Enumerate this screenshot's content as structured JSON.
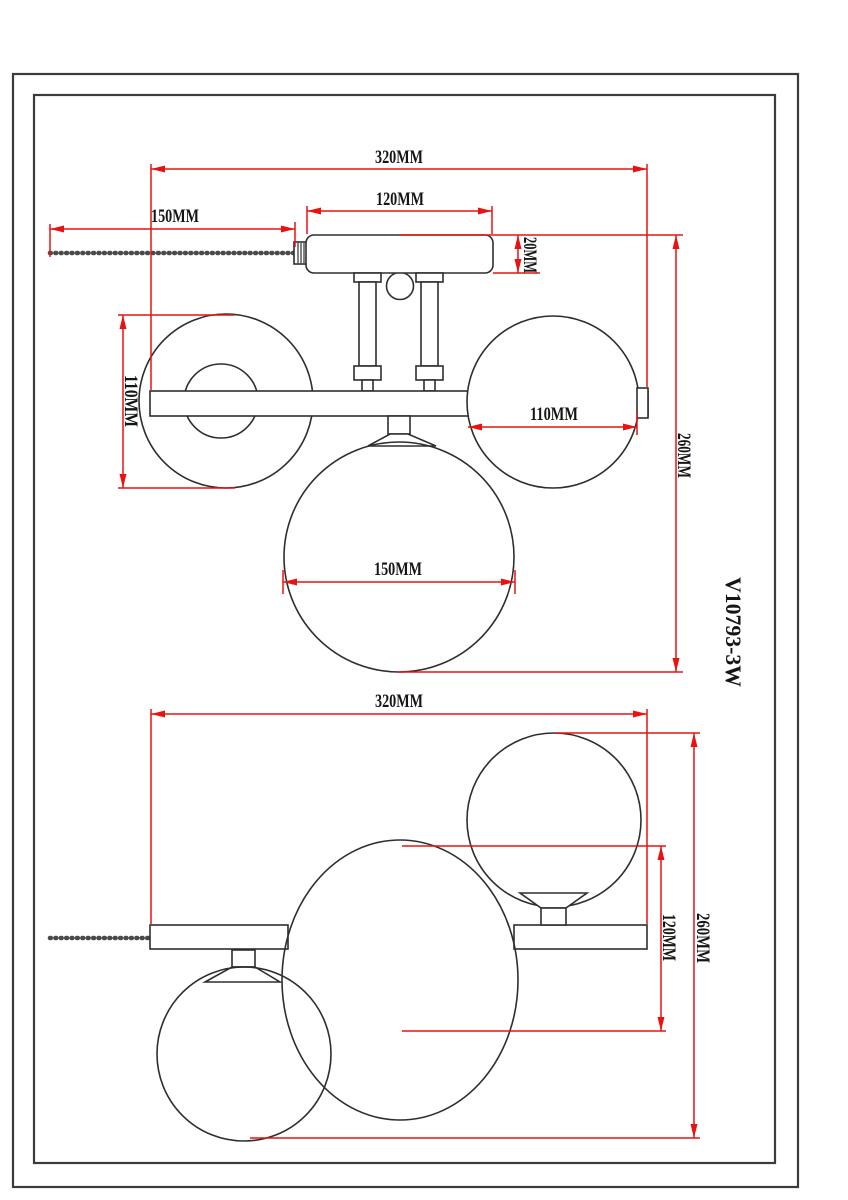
{
  "model_code": "V10793-3W",
  "colors": {
    "dimension_color": "#e81212",
    "outline_color": "#2e2e2e",
    "frame_color": "#3b3b3b",
    "background": "#ffffff"
  },
  "dimensions": {
    "side": {
      "overall_width": "320MM",
      "canopy_width": "120MM",
      "chain_length": "150MM",
      "canopy_height": "20MM",
      "left_globe_diameter": "110MM",
      "right_globe_diameter": "110MM",
      "large_globe_diameter": "150MM",
      "overall_height": "260MM"
    },
    "plan": {
      "overall_width": "320MM",
      "globe_offset": "120MM",
      "overall_depth": "260MM"
    }
  }
}
